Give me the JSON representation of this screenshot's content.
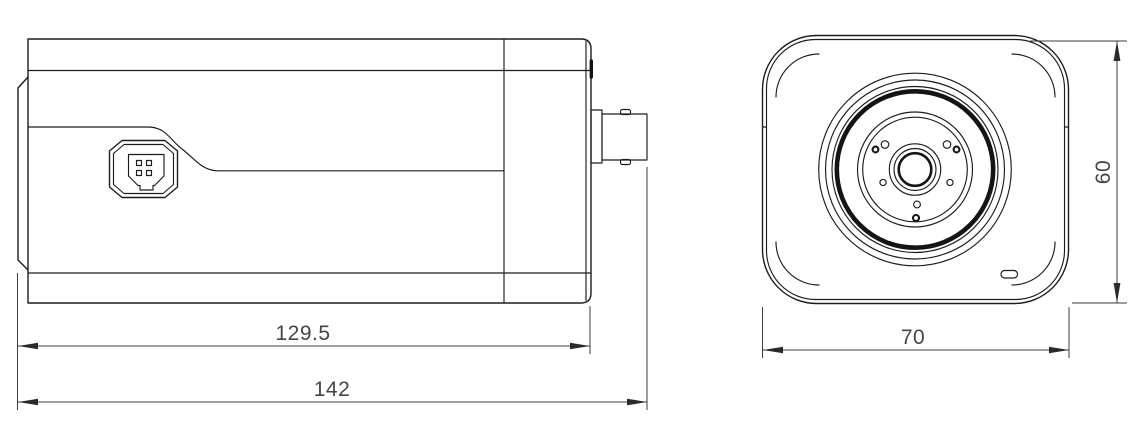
{
  "title": "Box camera dimension drawing",
  "views": {
    "side_view": {
      "name": "side-view",
      "features": [
        "lens-mount-flange",
        "aux-connector",
        "bnc-connector",
        "housing-seam-curve",
        "back-panel"
      ],
      "dimensions": [
        {
          "id": "body_length",
          "value": "129.5"
        },
        {
          "id": "total_length_with_bnc",
          "value": "142"
        }
      ]
    },
    "front_view": {
      "name": "front-view",
      "features": [
        "rounded-face",
        "mount-rings",
        "gasket-ring",
        "lens-plate",
        "lens-aperture",
        "screw-holes",
        "led-slot"
      ],
      "dimensions": [
        {
          "id": "width",
          "value": "70"
        },
        {
          "id": "height",
          "value": "60"
        }
      ]
    }
  },
  "colors": {
    "outline": "#1c1c1c",
    "dimension": "#3c3c3c",
    "text": "#454545",
    "background": "#ffffff"
  }
}
